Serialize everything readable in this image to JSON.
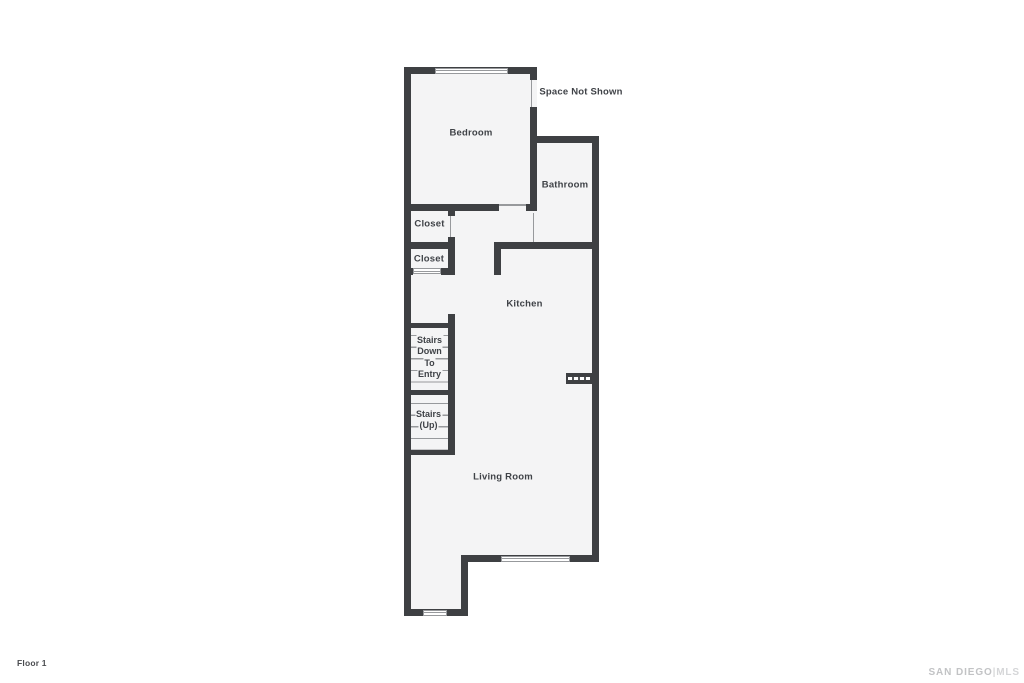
{
  "floor_plan": {
    "rooms": {
      "bedroom": "Bedroom",
      "bathroom": "Bathroom",
      "kitchen": "Kitchen",
      "living_room": "Living Room",
      "closet_1": "Closet",
      "closet_2": "Closet",
      "space_not_shown": "Space Not Shown"
    },
    "stairs_down": {
      "lines": [
        "Stairs",
        "Down",
        "To",
        "Entry"
      ]
    },
    "stairs_up": {
      "lines": [
        "Stairs",
        "(Up)"
      ]
    }
  },
  "footer": {
    "floor_label": "Floor 1"
  },
  "watermark": {
    "brand": "SAN DIEGO",
    "separator": "|",
    "suffix": "MLS"
  },
  "colors": {
    "wall": "#3e4043",
    "room_fill": "#f4f4f5",
    "thin_line": "#97999c",
    "label_text": "#3f4247",
    "watermark": "#c2c3c5",
    "background": "#ffffff"
  }
}
